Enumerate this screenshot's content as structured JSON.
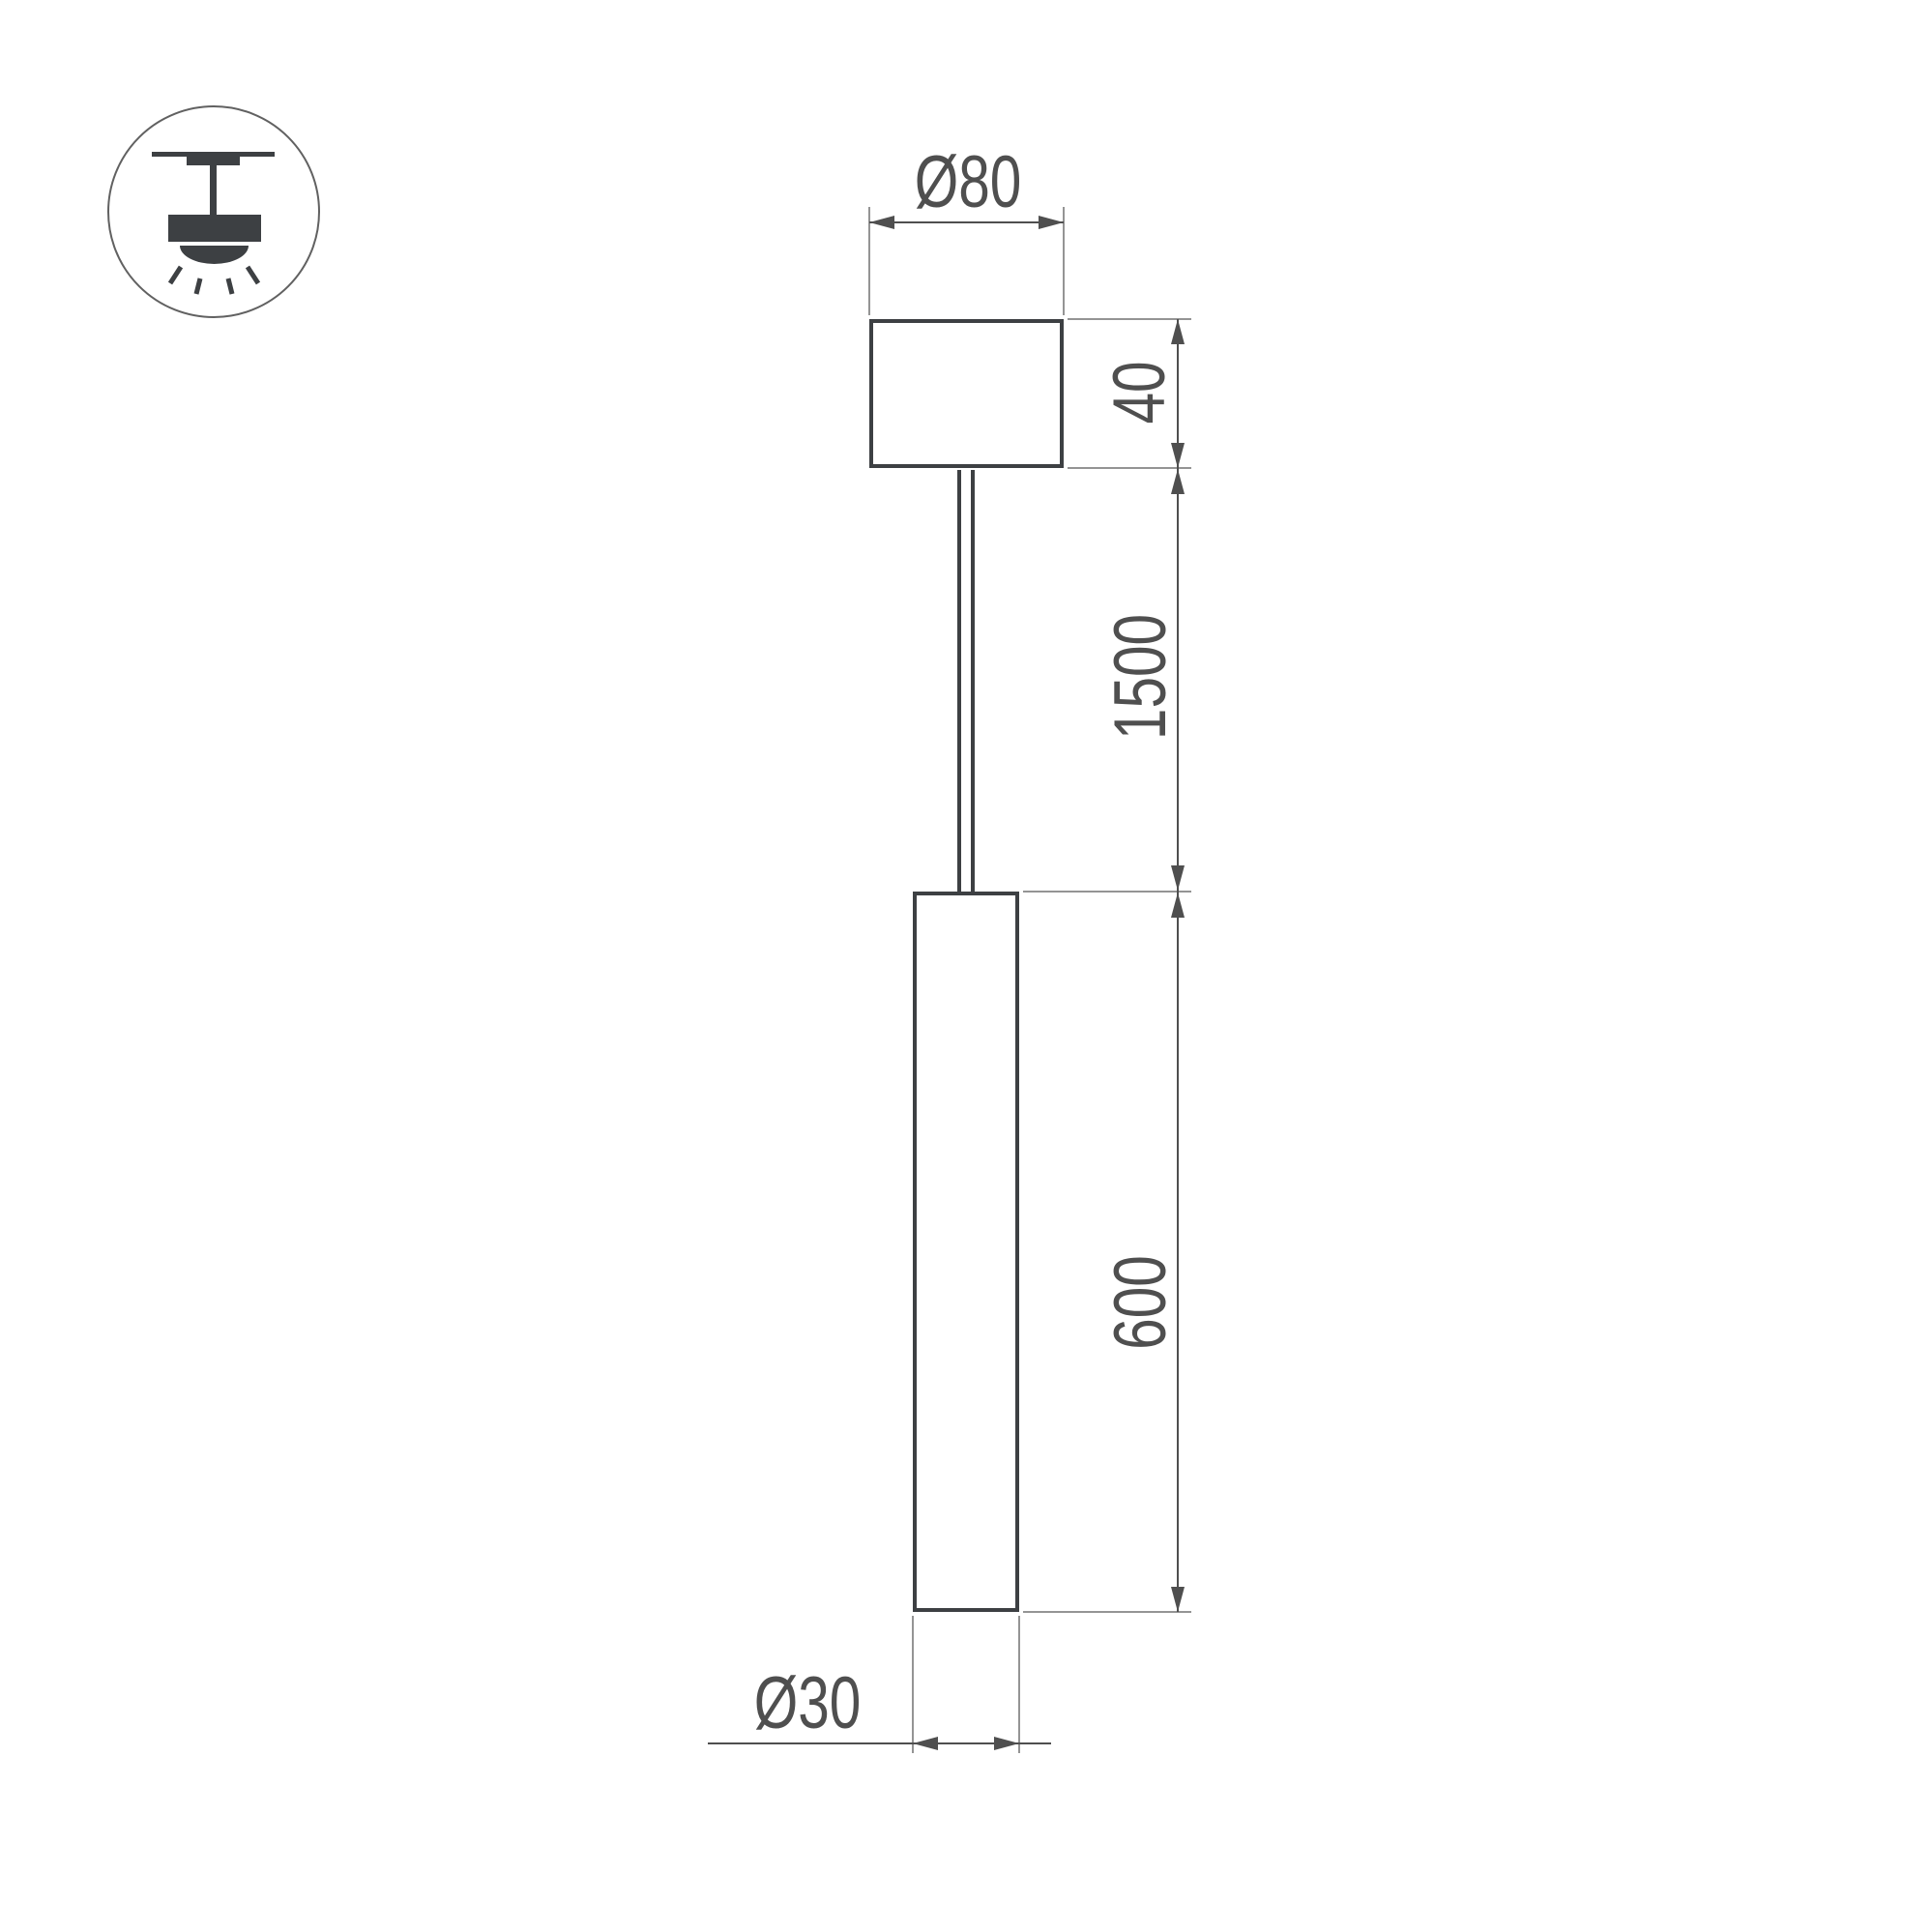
{
  "icon": {
    "name": "pendant-ceiling-light",
    "description": "suspended pendant luminaire mounting pictogram"
  },
  "dimensions": {
    "canopy_diameter": "Ø80",
    "canopy_height": "40",
    "suspension_length": "1500",
    "tube_length": "600",
    "tube_diameter": "Ø30"
  },
  "colors": {
    "outline": "#3d4043",
    "dimension": "#4f4f4f",
    "extension": "#949494",
    "background": "#ffffff"
  }
}
